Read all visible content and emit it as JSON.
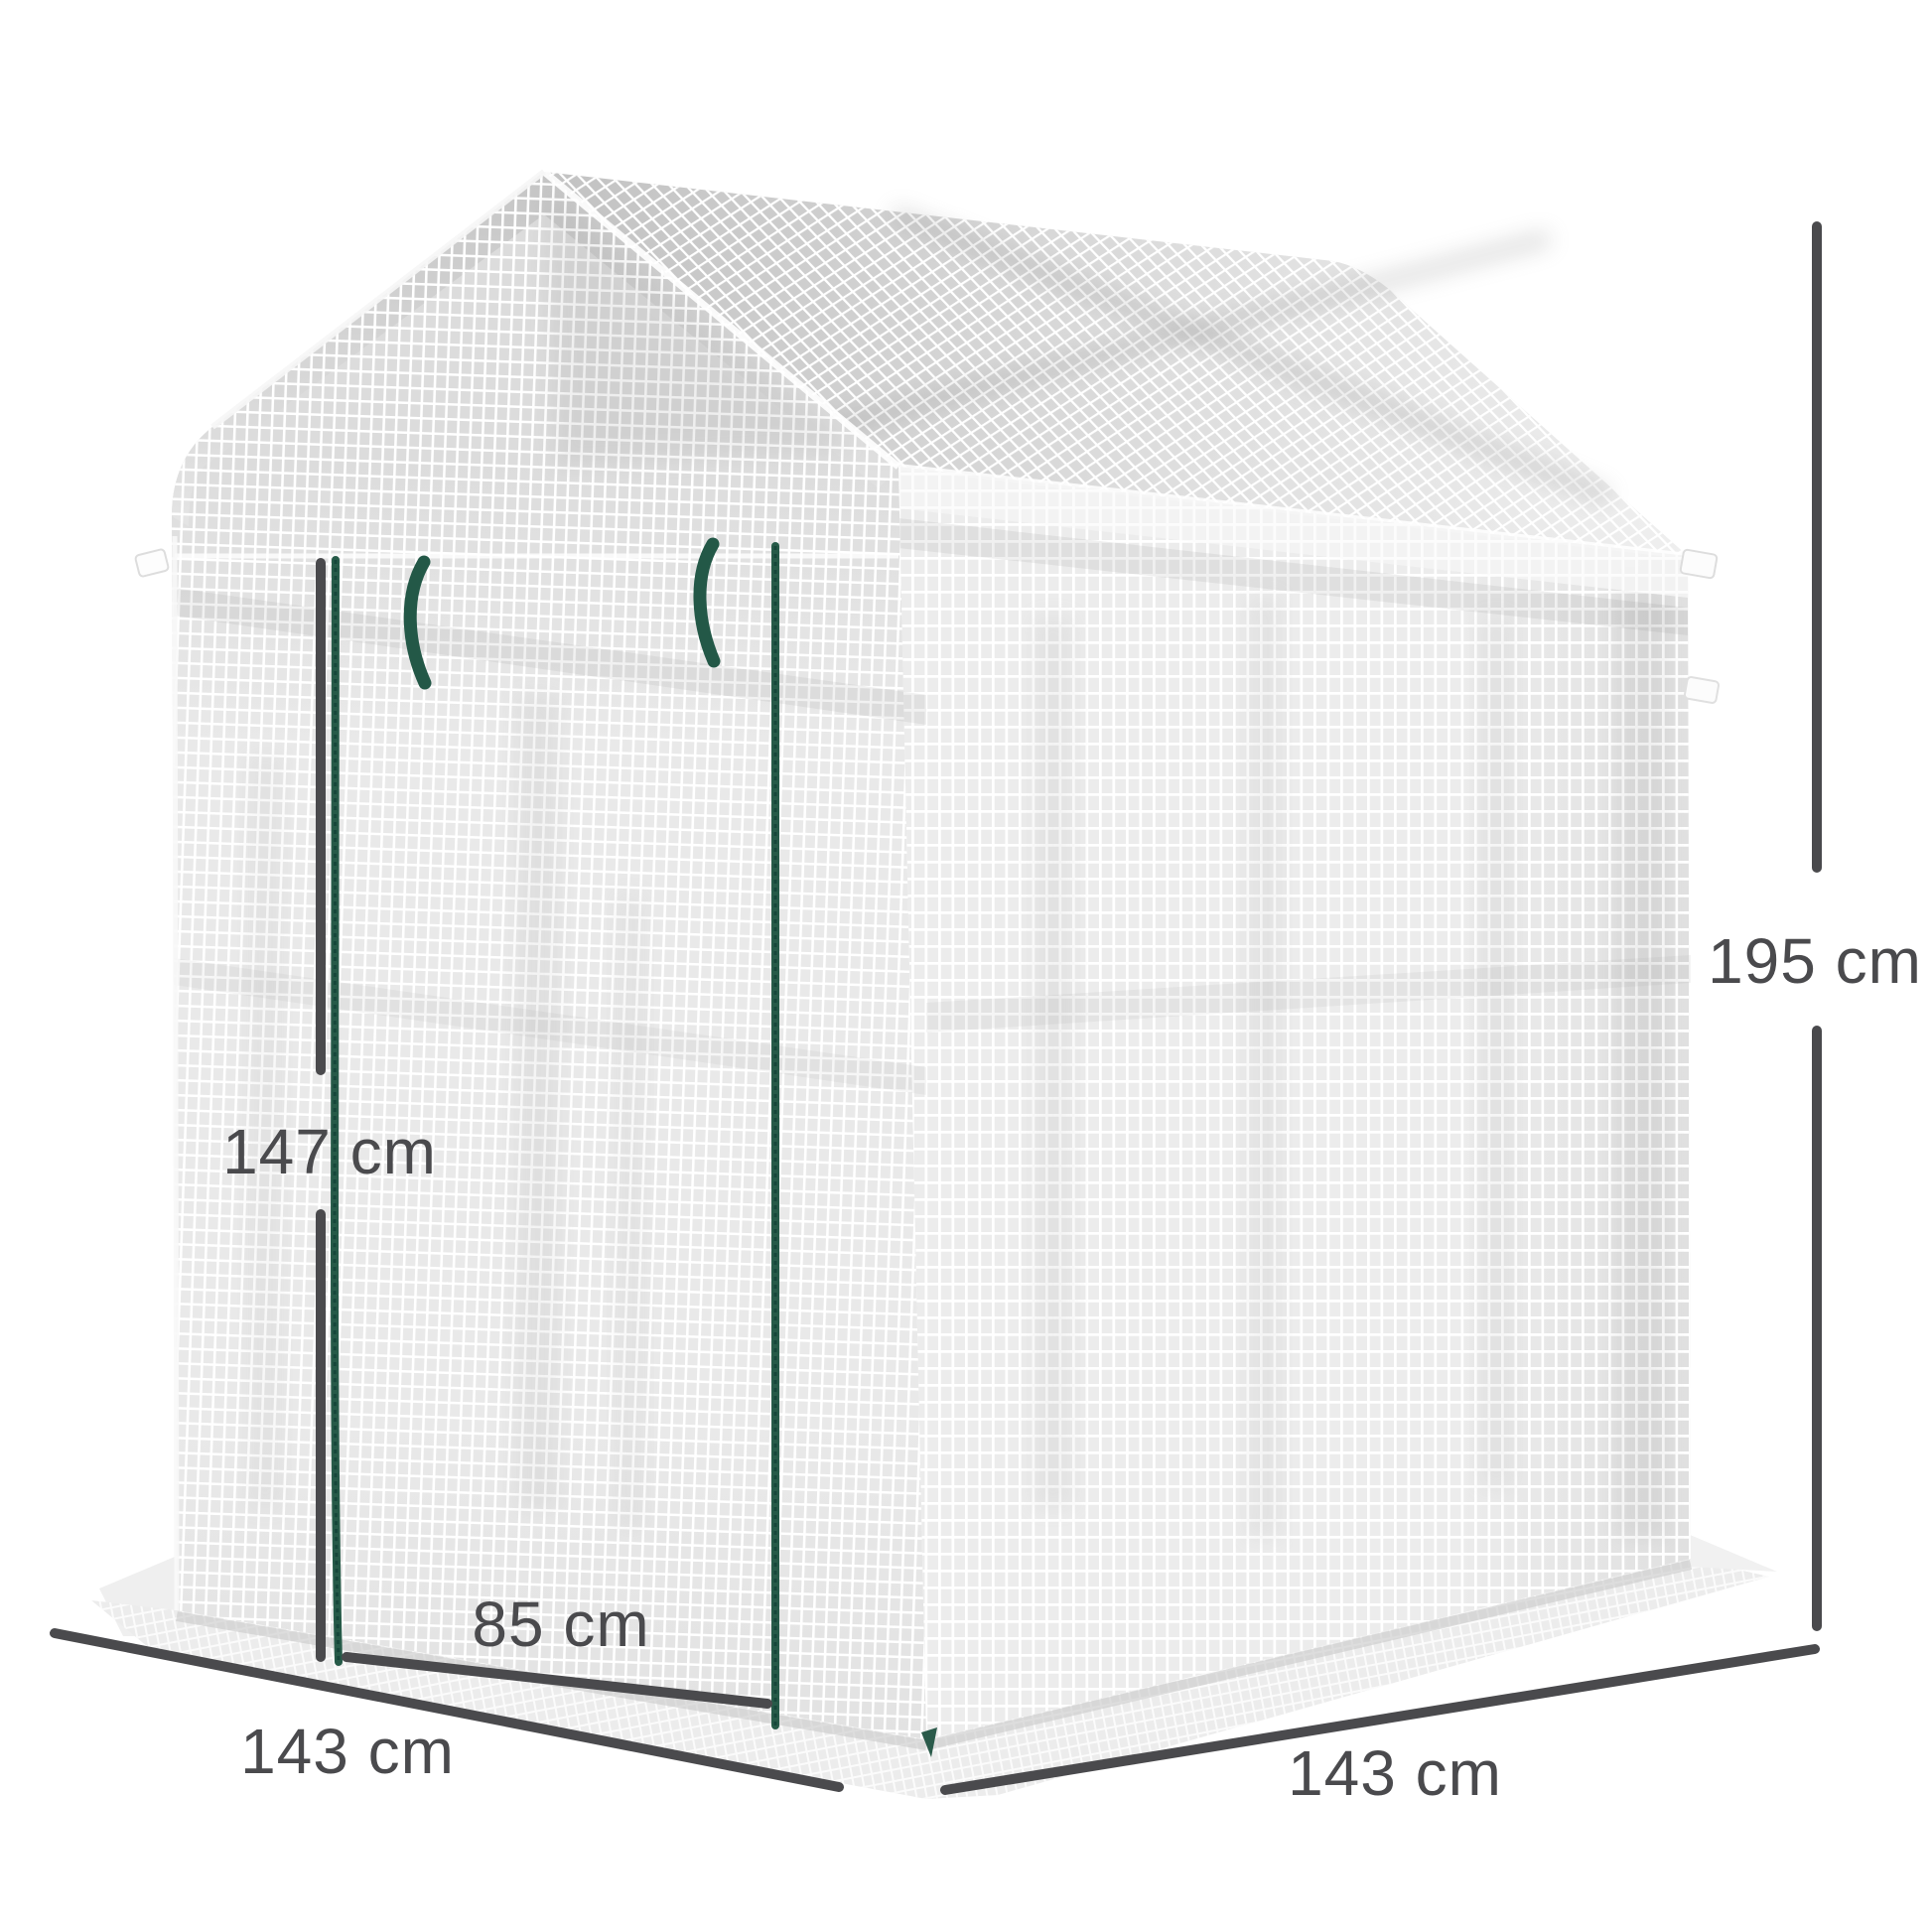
{
  "figure": {
    "type": "product-dimension-diagram",
    "subject": "walk-in mesh greenhouse with peaked roof and zip door"
  },
  "labels": {
    "total_height": "195 cm",
    "door_height": "147 cm",
    "door_width": "85 cm",
    "depth_left": "143 cm",
    "width_right": "143 cm"
  },
  "colors": {
    "annotation": "#4a4a4d",
    "zipper_green": "#265a48",
    "mesh_light": "#e8e8e8",
    "background": "#ffffff"
  }
}
